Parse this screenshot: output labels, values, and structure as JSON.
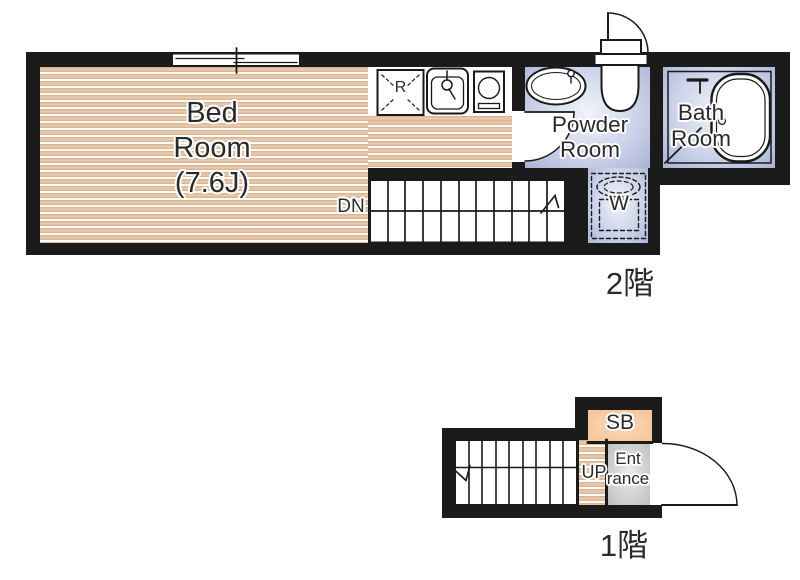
{
  "floor2": {
    "floor_label": "2階",
    "bedroom": {
      "line1": "Bed",
      "line2": "Room",
      "line3": "(7.6J)"
    },
    "kitchen": {
      "refrigerator_label": "R"
    },
    "powder_room": {
      "line1": "Powder",
      "line2": "Room"
    },
    "bath_room": {
      "line1": "Bath",
      "line2": "Room"
    },
    "washer_label": "W",
    "stairs_label": "DN"
  },
  "floor1": {
    "floor_label": "1階",
    "shoe_box_label": "SB",
    "stairs_label": "UP",
    "entrance": {
      "line1": "Ent",
      "line2": "rance"
    }
  },
  "colors": {
    "wall": "#1b1b1b",
    "wood_floor": "#d8af8a",
    "wet_area_floor": "#a9b3d6",
    "shoe_box": "#f6c79c",
    "entrance_floor": "#bfbfbf",
    "text": "#2a2a2a"
  }
}
